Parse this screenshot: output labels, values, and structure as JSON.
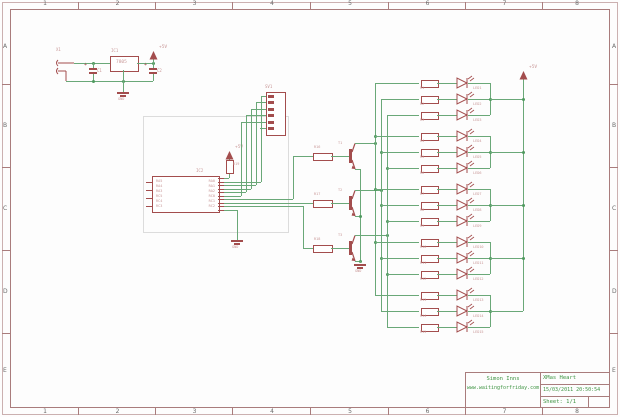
{
  "frame": {
    "columns": [
      "1",
      "2",
      "3",
      "4",
      "5",
      "6",
      "7",
      "8"
    ],
    "rows": [
      "A",
      "B",
      "C",
      "D",
      "E"
    ]
  },
  "title_block": {
    "author": "Simon Inns",
    "website": "www.waitingforfriday.com",
    "project": "XMas Heart",
    "datetime": "15/03/2011 20:50:54",
    "sheet": "Sheet: 1/1"
  },
  "power": {
    "jack_ref": "X1",
    "cap1_ref": "C1",
    "cap2_ref": "C2",
    "regulator_ref": "IC1",
    "regulator_value": "7805",
    "vcc_label": "+5V",
    "gnd_label": "GND",
    "plus_sign": "+"
  },
  "mcu": {
    "ref": "IC2",
    "connector_ref": "SV1",
    "pullup_ref": "R19",
    "vcc_label": "+5V",
    "gnd_label": "GND",
    "left_pins": [
      "RA5",
      "RA4",
      "RA3",
      "RC5",
      "RC4",
      "RC3"
    ],
    "right_pins": [
      "RA0",
      "RA1",
      "RA2",
      "RC0",
      "RC1",
      "RC2"
    ]
  },
  "drivers": {
    "transistor_refs": [
      "T1",
      "T2",
      "T3"
    ],
    "base_resistor_refs": [
      "R16",
      "R17",
      "R18"
    ],
    "gnd_label": "GND"
  },
  "led_array": {
    "vcc_label": "+5V",
    "resistor_refs": [
      "R1",
      "R2",
      "R3",
      "R4",
      "R5",
      "R6",
      "R7",
      "R8",
      "R9",
      "R10",
      "R11",
      "R12",
      "R13",
      "R14",
      "R15"
    ],
    "led_refs": [
      "LED1",
      "LED2",
      "LED3",
      "LED4",
      "LED5",
      "LED6",
      "LED7",
      "LED8",
      "LED9",
      "LED10",
      "LED11",
      "LED12",
      "LED13",
      "LED14",
      "LED15"
    ]
  },
  "colors": {
    "wire": "#6aa878",
    "symbol": "#a34d4d",
    "symbol_fill": "#a83c3c",
    "label": "#c99898",
    "junction": "#4f9a5f",
    "frame_line": "#a97c7c",
    "green_text": "#3f9443",
    "section_box": "#dcdcdc"
  }
}
